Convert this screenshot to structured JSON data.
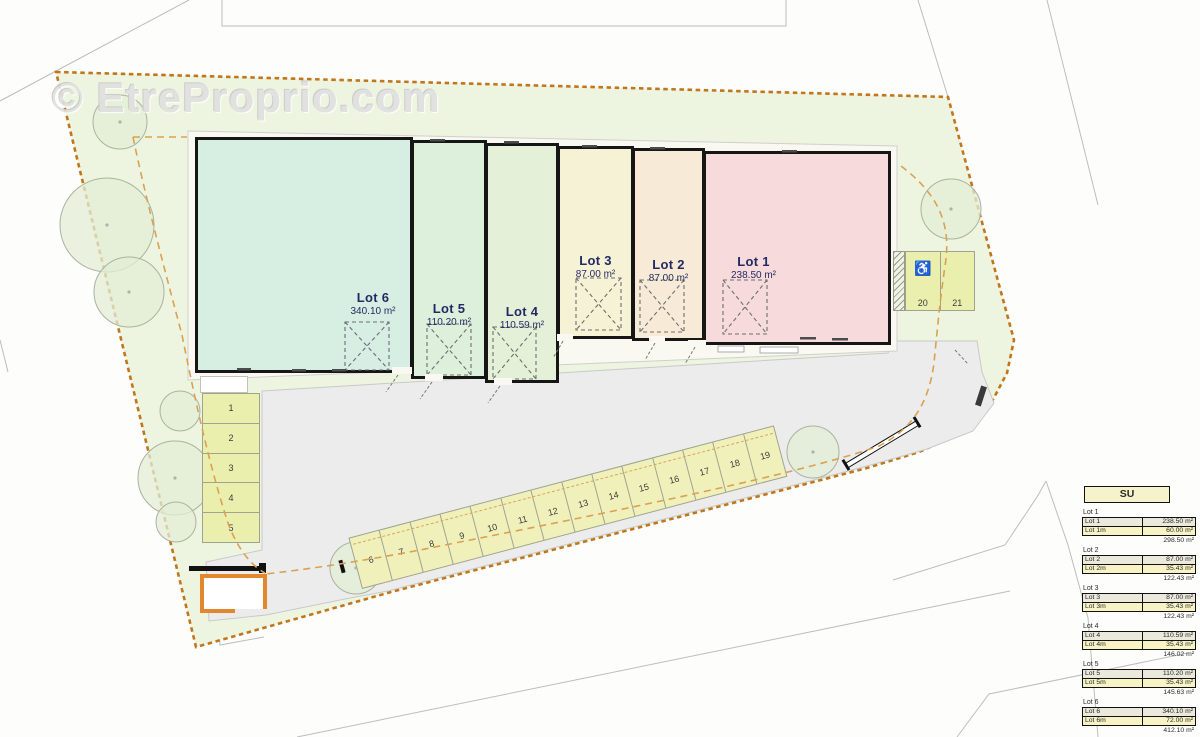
{
  "watermark": "© EtreProprio.com",
  "plan": {
    "lots": [
      {
        "name": "Lot 6",
        "area": "340.10 m²"
      },
      {
        "name": "Lot 5",
        "area": "110.20 m²"
      },
      {
        "name": "Lot 4",
        "area": "110.59 m²"
      },
      {
        "name": "Lot 3",
        "area": "87.00 m²"
      },
      {
        "name": "Lot 2",
        "area": "87.00 m²"
      },
      {
        "name": "Lot 1",
        "area": "238.50 m²"
      }
    ],
    "parking": {
      "left_column": [
        "1",
        "2",
        "3",
        "4",
        "5"
      ],
      "diagonal_row": [
        "6",
        "7",
        "8",
        "9",
        "10",
        "11",
        "12",
        "13",
        "14",
        "15",
        "16",
        "17",
        "18",
        "19"
      ],
      "right_pair": [
        "20",
        "21"
      ],
      "handicap_icon": "♿"
    },
    "colors": {
      "site_fill": "#edf5e0",
      "boundary_orange": "#c2761c",
      "courtyard_gray": "#ececec",
      "lot6": "#d7eee3",
      "lot5": "#dcf0db",
      "lot4": "#e4f1d8",
      "lot3": "#f6f2d5",
      "lot2": "#f7ebd8",
      "lot1": "#f7dadb",
      "parking_fill": "#eaefae",
      "label_navy": "#232a63",
      "enclosure_orange": "#e2872e"
    }
  },
  "table": {
    "title": "SU",
    "groups": [
      {
        "label": "Lot 1",
        "rows": [
          {
            "name": "Lot 1",
            "value": "238.50 m²"
          },
          {
            "name": "Lot 1m",
            "value": "60.00 m²"
          }
        ],
        "subtotal": "298.50 m²"
      },
      {
        "label": "Lot 2",
        "rows": [
          {
            "name": "Lot 2",
            "value": "87.00 m²"
          },
          {
            "name": "Lot 2m",
            "value": "35.43 m²"
          }
        ],
        "subtotal": "122.43 m²"
      },
      {
        "label": "Lot 3",
        "rows": [
          {
            "name": "Lot 3",
            "value": "87.00 m²"
          },
          {
            "name": "Lot 3m",
            "value": "35.43 m²"
          }
        ],
        "subtotal": "122.43 m²"
      },
      {
        "label": "Lot 4",
        "rows": [
          {
            "name": "Lot 4",
            "value": "110.59 m²"
          },
          {
            "name": "Lot 4m",
            "value": "35.43 m²"
          }
        ],
        "subtotal": "146.02 m²"
      },
      {
        "label": "Lot 5",
        "rows": [
          {
            "name": "Lot 5",
            "value": "110.20 m²"
          },
          {
            "name": "Lot 5m",
            "value": "35.43 m²"
          }
        ],
        "subtotal": "145.63 m²"
      },
      {
        "label": "Lot 6",
        "rows": [
          {
            "name": "Lot 6",
            "value": "340.10 m²"
          },
          {
            "name": "Lot 6m",
            "value": "72.00 m²"
          }
        ],
        "subtotal": "412.10 m²"
      }
    ],
    "total_label": "Total général",
    "total_value": "1247.10 m²"
  }
}
